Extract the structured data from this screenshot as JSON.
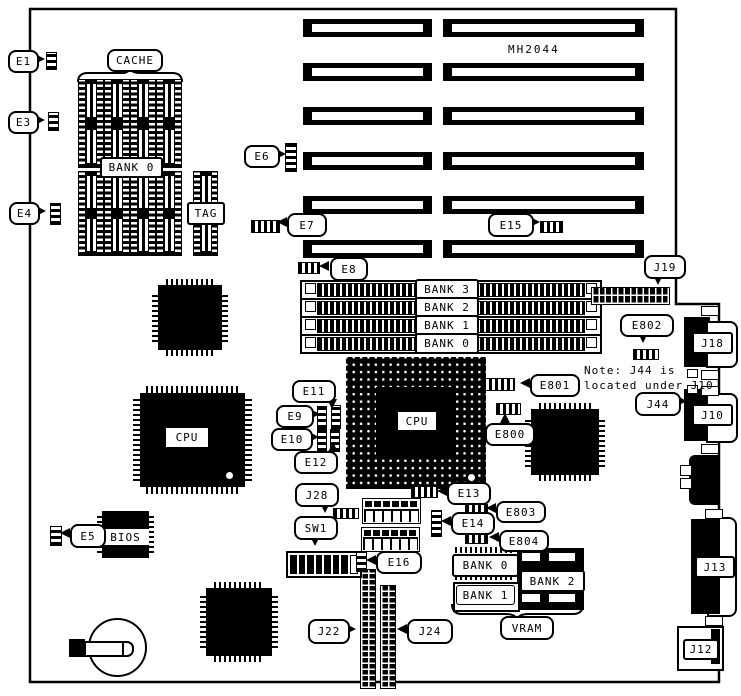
{
  "colors": {
    "ink": "#000000",
    "paper": "#ffffff"
  },
  "board": {
    "model": "MH2044"
  },
  "note": {
    "line1": "Note:  J44 is",
    "line2": "located under J10"
  },
  "cache": {
    "label": "CACHE",
    "bank": "BANK 0",
    "tag": "TAG"
  },
  "memory": {
    "banks": [
      "BANK 3",
      "BANK 2",
      "BANK 1",
      "BANK 0"
    ]
  },
  "vram": {
    "label": "VRAM",
    "bank0": "BANK 0",
    "bank1": "BANK 1",
    "bank2": "BANK 2"
  },
  "cpu": {
    "socket": "CPU",
    "chip": "CPU"
  },
  "bios": {
    "label": "BIOS"
  },
  "switch": {
    "sw1": "SW1"
  },
  "jumpers": {
    "e1": "E1",
    "e3": "E3",
    "e4": "E4",
    "e5": "E5",
    "e6": "E6",
    "e7": "E7",
    "e8": "E8",
    "e9": "E9",
    "e10": "E10",
    "e11": "E11",
    "e12": "E12",
    "e13": "E13",
    "e14": "E14",
    "e15": "E15",
    "e16": "E16",
    "e800": "E800",
    "e801": "E801",
    "e802": "E802",
    "e803": "E803",
    "e804": "E804"
  },
  "connectors": {
    "j10": "J10",
    "j12": "J12",
    "j13": "J13",
    "j18": "J18",
    "j19": "J19",
    "j22": "J22",
    "j24": "J24",
    "j28": "J28",
    "j44": "J44"
  }
}
